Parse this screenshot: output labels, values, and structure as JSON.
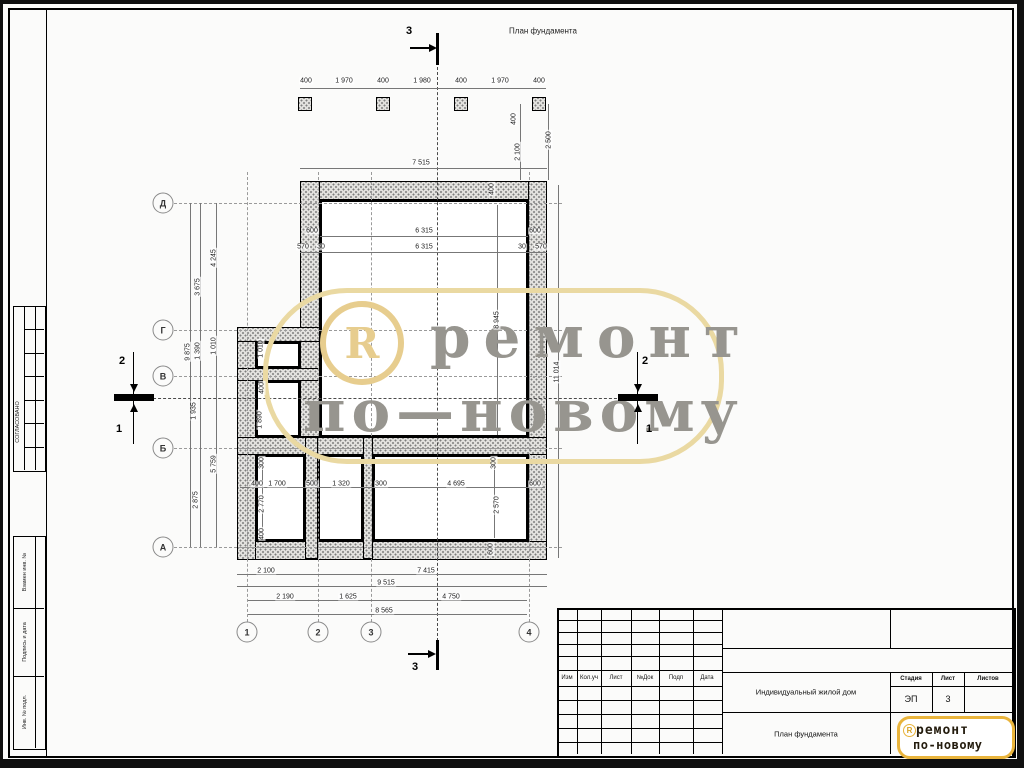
{
  "drawing": {
    "title": "План фундамента",
    "row_axes": [
      {
        "label": "Д",
        "y": 203
      },
      {
        "label": "Г",
        "y": 330
      },
      {
        "label": "В",
        "y": 376
      },
      {
        "label": "Б",
        "y": 448
      },
      {
        "label": "А",
        "y": 547
      }
    ],
    "col_axes": [
      {
        "label": "1",
        "x": 247
      },
      {
        "label": "2",
        "x": 318
      },
      {
        "label": "3",
        "x": 371
      },
      {
        "label": "4",
        "x": 529
      }
    ],
    "sections": {
      "top": "3",
      "bottom": "3",
      "left_upper": "2",
      "left_lower": "1",
      "right_upper": "2",
      "right_lower": "1"
    },
    "dim_labels": [
      {
        "t": "400",
        "x": 306,
        "y": 81
      },
      {
        "t": "1 970",
        "x": 344,
        "y": 81
      },
      {
        "t": "400",
        "x": 383,
        "y": 81
      },
      {
        "t": "1 980",
        "x": 422,
        "y": 81
      },
      {
        "t": "400",
        "x": 461,
        "y": 81
      },
      {
        "t": "1 970",
        "x": 500,
        "y": 81
      },
      {
        "t": "400",
        "x": 539,
        "y": 81
      },
      {
        "t": "7 515",
        "x": 421,
        "y": 163
      },
      {
        "t": "400",
        "x": 514,
        "y": 119,
        "r": 1
      },
      {
        "t": "2 100",
        "x": 518,
        "y": 152,
        "r": 1
      },
      {
        "t": "2 500",
        "x": 549,
        "y": 140,
        "r": 1
      },
      {
        "t": "600",
        "x": 312,
        "y": 231
      },
      {
        "t": "6 315",
        "x": 424,
        "y": 231
      },
      {
        "t": "600",
        "x": 535,
        "y": 231
      },
      {
        "t": "570",
        "x": 303,
        "y": 247
      },
      {
        "t": "30",
        "x": 321,
        "y": 247
      },
      {
        "t": "6 315",
        "x": 424,
        "y": 247
      },
      {
        "t": "30",
        "x": 522,
        "y": 247
      },
      {
        "t": "570",
        "x": 541,
        "y": 247
      },
      {
        "t": "400",
        "x": 492,
        "y": 189,
        "r": 1
      },
      {
        "t": "9 875",
        "x": 188,
        "y": 352,
        "r": 1
      },
      {
        "t": "3 675",
        "x": 198,
        "y": 287,
        "r": 1
      },
      {
        "t": "1 390",
        "x": 198,
        "y": 351,
        "r": 1
      },
      {
        "t": "1 935",
        "x": 194,
        "y": 411,
        "r": 1
      },
      {
        "t": "2 875",
        "x": 196,
        "y": 500,
        "r": 1
      },
      {
        "t": "4 245",
        "x": 214,
        "y": 258,
        "r": 1
      },
      {
        "t": "1 010",
        "x": 214,
        "y": 346,
        "r": 1
      },
      {
        "t": "5 759",
        "x": 214,
        "y": 464,
        "r": 1
      },
      {
        "t": "1 010",
        "x": 261,
        "y": 349,
        "r": 1
      },
      {
        "t": "400",
        "x": 262,
        "y": 388,
        "r": 1
      },
      {
        "t": "1 890",
        "x": 260,
        "y": 420,
        "r": 1
      },
      {
        "t": "300",
        "x": 262,
        "y": 463,
        "r": 1
      },
      {
        "t": "400",
        "x": 257,
        "y": 484
      },
      {
        "t": "1 700",
        "x": 277,
        "y": 484
      },
      {
        "t": "500",
        "x": 312,
        "y": 484
      },
      {
        "t": "1 320",
        "x": 341,
        "y": 484
      },
      {
        "t": "300",
        "x": 381,
        "y": 484
      },
      {
        "t": "4 695",
        "x": 456,
        "y": 484
      },
      {
        "t": "600",
        "x": 535,
        "y": 484
      },
      {
        "t": "2 770",
        "x": 262,
        "y": 504,
        "r": 1
      },
      {
        "t": "400",
        "x": 262,
        "y": 534,
        "r": 1
      },
      {
        "t": "300",
        "x": 494,
        "y": 463,
        "r": 1
      },
      {
        "t": "2 570",
        "x": 497,
        "y": 505,
        "r": 1
      },
      {
        "t": "8 945",
        "x": 497,
        "y": 320,
        "r": 1
      },
      {
        "t": "11 014",
        "x": 557,
        "y": 372,
        "r": 1
      },
      {
        "t": "600",
        "x": 491,
        "y": 549,
        "r": 1
      },
      {
        "t": "2 100",
        "x": 266,
        "y": 571
      },
      {
        "t": "7 415",
        "x": 426,
        "y": 571
      },
      {
        "t": "9 515",
        "x": 386,
        "y": 583
      },
      {
        "t": "2 190",
        "x": 285,
        "y": 597
      },
      {
        "t": "1 625",
        "x": 348,
        "y": 597
      },
      {
        "t": "4 750",
        "x": 451,
        "y": 597
      },
      {
        "t": "8 565",
        "x": 384,
        "y": 611
      }
    ]
  },
  "watermark": {
    "reg": "R",
    "line1": "ремонт",
    "line2": "по—новому"
  },
  "stamps": {
    "approved": "СОГЛАСОВАНО",
    "replace_inv": "Взамен инв. №",
    "sign_date": "Подпись и дата",
    "inv_orig": "Инв. № подл."
  },
  "titleblock": {
    "rev_headers": [
      "Изм",
      "Кол.уч",
      "Лист",
      "№Док",
      "Подп",
      "Дата"
    ],
    "project": "Индивидуальный жилой дом",
    "doc_title": "План фундамента",
    "stage_label": "Стадия",
    "sheet_label": "Лист",
    "sheets_label": "Листов",
    "stage_value": "ЭП",
    "sheet_value": "3",
    "sheets_value": "",
    "logo": {
      "reg": "R",
      "line1": "ремонт",
      "line2": "по-новому"
    }
  }
}
